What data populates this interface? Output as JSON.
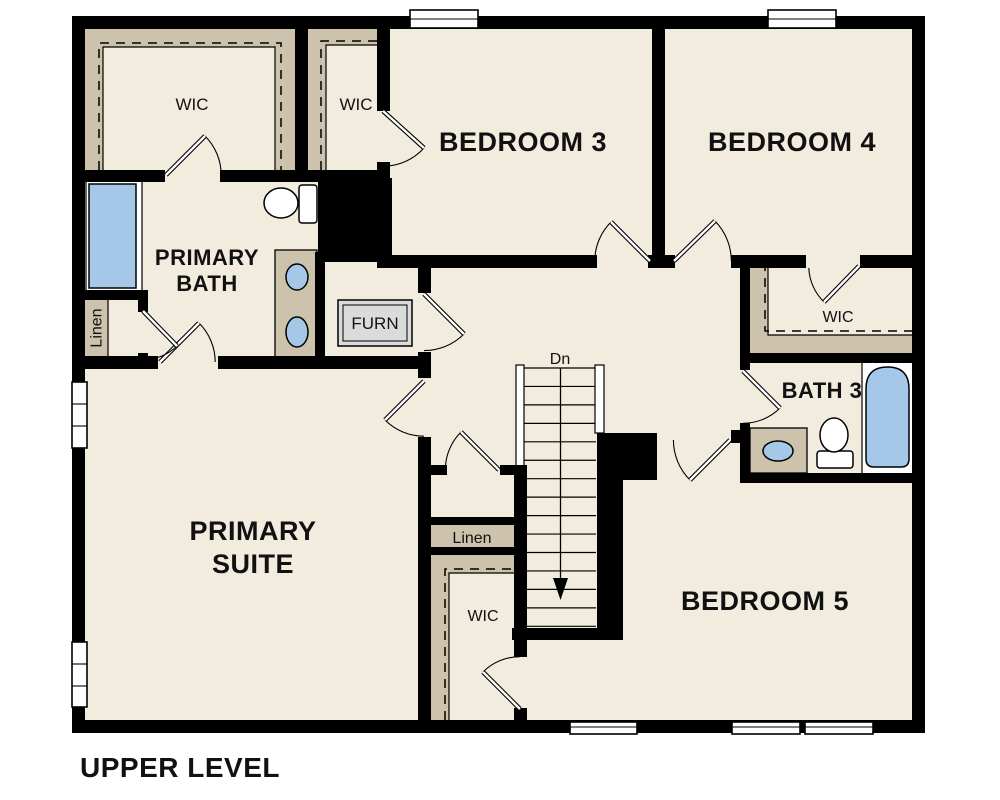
{
  "title": "UPPER LEVEL",
  "colors": {
    "background": "#ffffff",
    "floor": "#f2ecdf",
    "shelf": "#cdc2ab",
    "fixture_blue": "#a5c8e9",
    "wall": "#000000",
    "furnace_fill": "#dbdbdb"
  },
  "labels": {
    "primary_wic": "WIC",
    "bed3_wic": "WIC",
    "bedroom3": "BEDROOM 3",
    "bedroom4": "BEDROOM 4",
    "primary_bath_line1": "PRIMARY",
    "primary_bath_line2": "BATH",
    "linen_upper": "Linen",
    "furnace": "FURN",
    "stairs_direction": "Dn",
    "primary_suite_line1": "PRIMARY",
    "primary_suite_line2": "SUITE",
    "bed4_wic": "WIC",
    "bath3": "BATH 3",
    "linen_lower": "Linen",
    "hall_wic": "WIC",
    "bedroom5": "BEDROOM 5"
  }
}
